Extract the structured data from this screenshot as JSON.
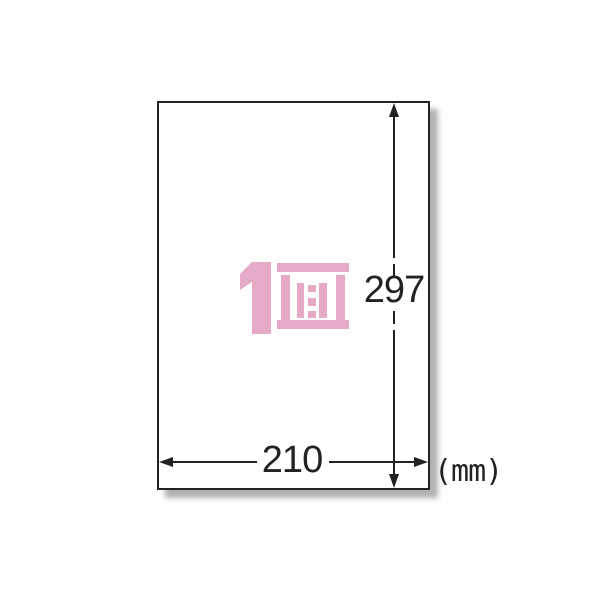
{
  "diagram": {
    "paper": {
      "label": "1面"
    },
    "dimensions": {
      "height_mm": "297",
      "width_mm": "210",
      "unit": "(mm)"
    },
    "colors": {
      "label_pink": "#e5abc6",
      "line_dark": "#222222"
    }
  }
}
